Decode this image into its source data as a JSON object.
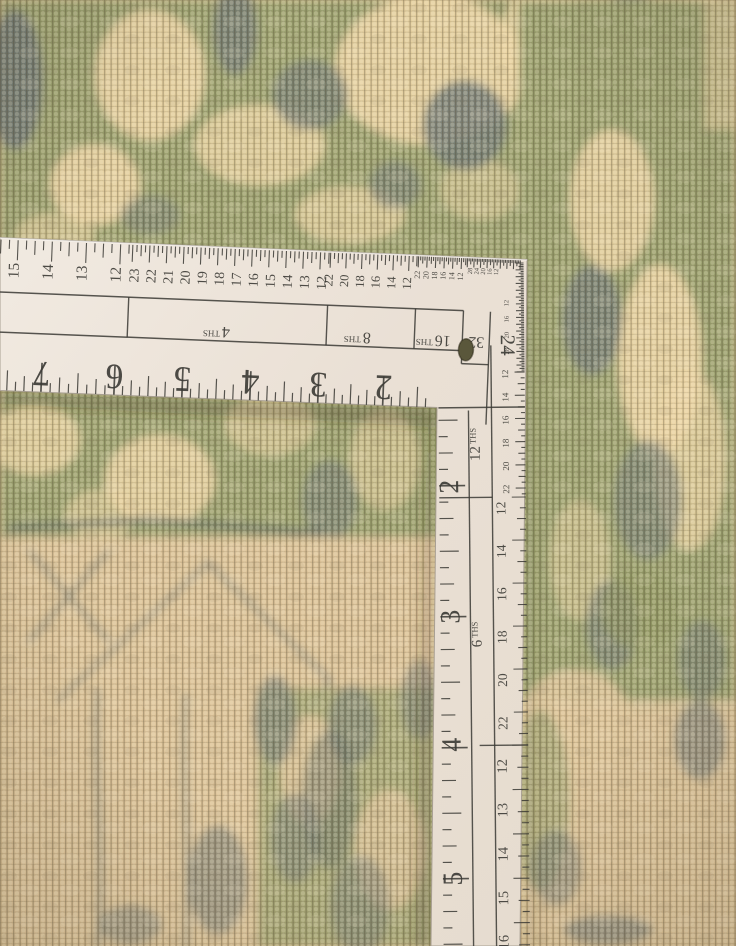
{
  "ruler": {
    "face_color": "#eee6dc",
    "face_color_dark": "#e4d9cd",
    "ink_color": "#3b3a35",
    "hole_color": "#5a573b",
    "horizontal_arm": {
      "bottom_scale": {
        "numbers": [
          "7",
          "6",
          "5",
          "4",
          "3",
          "2"
        ],
        "xs": [
          47,
          120,
          188,
          256,
          324,
          389
        ]
      },
      "top_scales": [
        {
          "name": "halves-scale",
          "numbers": [
            "15",
            "14",
            "13",
            "12"
          ],
          "xs": [
            20,
            54,
            88,
            122
          ],
          "font": 15.5,
          "tick_step": 8.55,
          "range": [
            -16,
            131
          ],
          "pattern": [
            20,
            9,
            14,
            9
          ],
          "num_y": 270
        },
        {
          "name": "fourths-scale",
          "numbers": [
            "23",
            "22",
            "21",
            "20",
            "19",
            "18",
            "17",
            "16",
            "15",
            "14",
            "13",
            "12"
          ],
          "x_start": 140,
          "x_step": 17.05,
          "font": 14,
          "tick_step": 4.27,
          "range": [
            133,
            330
          ],
          "pattern": [
            17,
            7,
            11,
            7
          ],
          "num_y": 270
        },
        {
          "name": "eighths-scale",
          "numbers": [
            "22",
            "20",
            "18",
            "16",
            "14",
            "12"
          ],
          "x_start": 334,
          "x_step": 15.7,
          "font": 12.5,
          "tick_step": 3.93,
          "range": [
            331,
            418
          ],
          "pattern": [
            15,
            6,
            10,
            6
          ],
          "num_y": 267
        },
        {
          "name": "sixteenths-scale",
          "numbers": [
            "22",
            "20",
            "18",
            "16",
            "14",
            "12"
          ],
          "x_start": 421,
          "x_step": 8.6,
          "font": 8,
          "tick_step": 2.15,
          "range": [
            419,
            467
          ],
          "pattern": [
            11,
            4,
            7,
            4
          ],
          "num_y": 258
        },
        {
          "name": "thirtyseconds-scale",
          "numbers": [
            "28",
            "24",
            "20",
            "16",
            "12"
          ],
          "x_start": 473,
          "x_step": 6.5,
          "font": 6.5,
          "tick_step": 1.65,
          "range": [
            468,
            522
          ],
          "pattern": [
            9,
            3,
            6,
            3
          ],
          "num_y": 252
        }
      ],
      "band_labels": [
        {
          "num": "4",
          "suffix": "THS",
          "x": 220
        },
        {
          "num": "8",
          "suffix": "THS",
          "x": 361
        },
        {
          "num": "16",
          "suffix": "THS",
          "x": 437
        },
        {
          "num": "32",
          "suffix": "",
          "x": 480
        }
      ]
    },
    "vertical_arm": {
      "corner_number": "24",
      "left_scale": {
        "numbers": [
          "2",
          "3",
          "4",
          "5"
        ],
        "ys": [
          486,
          616,
          744,
          878
        ],
        "unit_start": 354,
        "unit_step": 131,
        "pattern": [
          26,
          9,
          14,
          9,
          19,
          9,
          14,
          9
        ],
        "font": 28
      },
      "mid_labels": [
        {
          "num": "12",
          "suffix": "THS",
          "y": 444
        },
        {
          "num": "6",
          "suffix": "THS",
          "y": 634
        }
      ],
      "right_scales": [
        {
          "name": "corner-fine-scale",
          "numbers": [
            "12",
            "16",
            "20",
            "28"
          ],
          "ys": [
            303,
            319,
            335,
            351
          ],
          "font": 6.5,
          "num_x": 508,
          "tick_step": 1.7,
          "range": [
            263,
            372
          ],
          "pattern": [
            8,
            3,
            5,
            3
          ]
        },
        {
          "name": "upper-scale",
          "numbers": [
            "12",
            "14",
            "16",
            "18",
            "20",
            "22"
          ],
          "ys": [
            374,
            397,
            420,
            443,
            466,
            489
          ],
          "font": 9,
          "num_x": 507,
          "tick_step": 5.8,
          "range": [
            372,
            496
          ],
          "pattern": [
            10,
            4,
            7,
            4
          ]
        },
        {
          "name": "middle-scale",
          "numbers": [
            "12",
            "14",
            "16",
            "18",
            "20",
            "22"
          ],
          "ys": [
            508,
            551,
            594,
            637,
            680,
            723
          ],
          "font": 13.5,
          "num_x": 503,
          "tick_step": 10.75,
          "range": [
            497,
            744
          ],
          "pattern": [
            14,
            6,
            9,
            6
          ]
        },
        {
          "name": "lower-scale",
          "numbers": [
            "12",
            "13",
            "14",
            "15",
            "16"
          ],
          "ys": [
            766,
            810,
            854,
            898,
            942
          ],
          "font": 14.5,
          "num_x": 502,
          "tick_step": 11.1,
          "range": [
            745,
            950
          ],
          "pattern": [
            16,
            7,
            11,
            7
          ]
        }
      ]
    }
  },
  "carpet": {
    "palette": {
      "base": "#d3ba8e",
      "tan": "#dcc298",
      "green": "#9aa06e",
      "green_deep": "#8e955f",
      "cream": "#ecd4a4",
      "gray": "#6f7874",
      "gray_dark": "#5b6562"
    }
  }
}
